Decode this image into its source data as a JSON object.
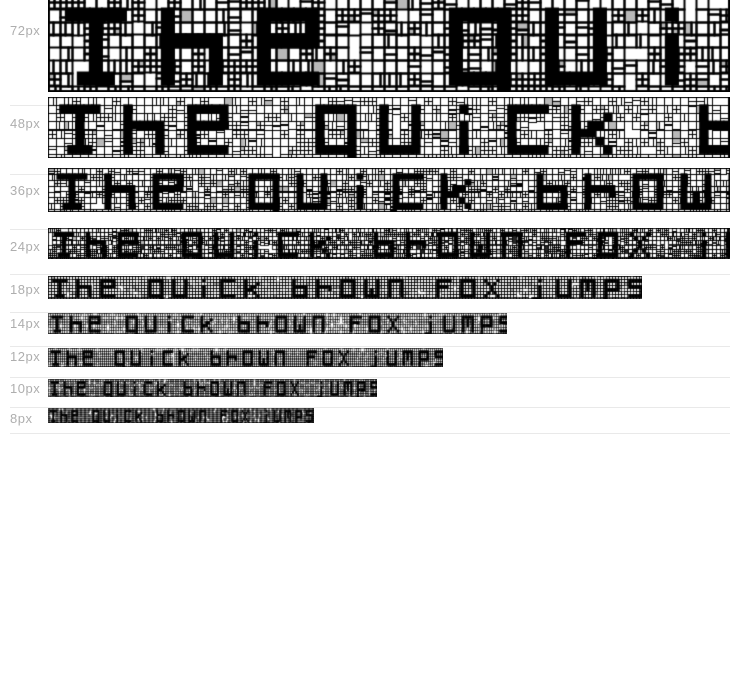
{
  "preview": {
    "sample_text": "The quick brown fox jumps",
    "rows": [
      {
        "label": "72px",
        "size": 72
      },
      {
        "label": "48px",
        "size": 48
      },
      {
        "label": "36px",
        "size": 36
      },
      {
        "label": "24px",
        "size": 24
      },
      {
        "label": "18px",
        "size": 18
      },
      {
        "label": "14px",
        "size": 14
      },
      {
        "label": "12px",
        "size": 12
      },
      {
        "label": "10px",
        "size": 10
      },
      {
        "label": "8px",
        "size": 8
      }
    ]
  },
  "colors": {
    "background": "#ffffff",
    "label_text": "#aeaeae",
    "separator": "#e9e9e9",
    "glyph": "#000000",
    "grid_line": "#000000",
    "gray_cell": "rgba(0,0,0,0.28)"
  }
}
